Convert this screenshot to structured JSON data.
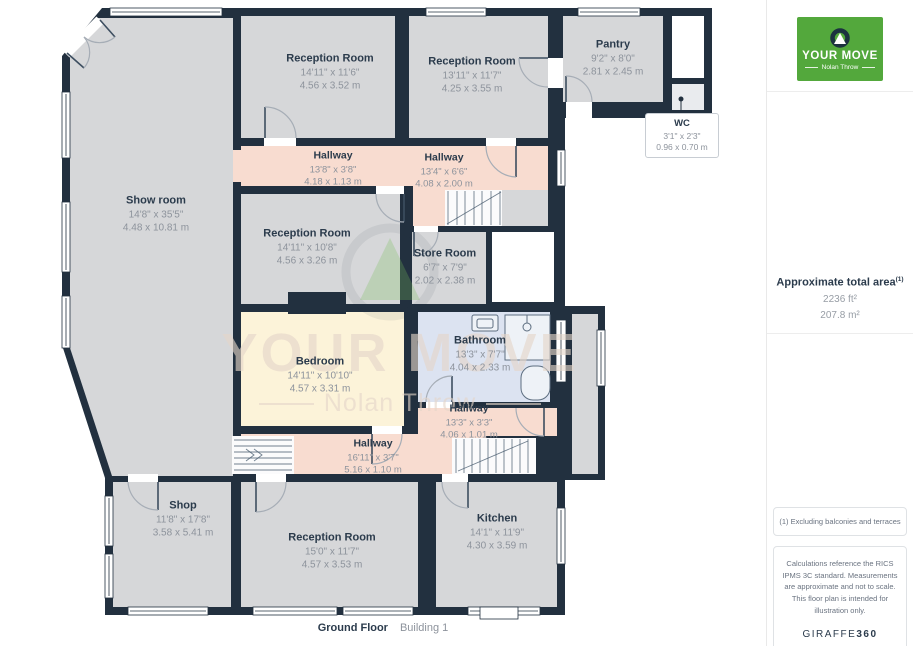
{
  "floorplan": {
    "footer": {
      "floor_label": "Ground Floor",
      "building_label": "Building 1"
    },
    "watermark": {
      "line1": "YOUR MOVE",
      "line2": "Nolan Throw"
    },
    "rooms": [
      {
        "name": "Reception Room",
        "imperial": "14'11\" x 11'6\"",
        "metric": "4.56 x 3.52 m"
      },
      {
        "name": "Reception Room",
        "imperial": "13'11\" x 11'7\"",
        "metric": "4.25 x 3.55 m"
      },
      {
        "name": "Pantry",
        "imperial": "9'2\" x 8'0\"",
        "metric": "2.81 x 2.45 m"
      },
      {
        "name": "WC",
        "imperial": "3'1\" x 2'3\"",
        "metric": "0.96 x 0.70 m"
      },
      {
        "name": "Show room",
        "imperial": "14'8\" x 35'5\"",
        "metric": "4.48 x 10.81 m"
      },
      {
        "name": "Hallway",
        "imperial": "13'8\" x 3'8\"",
        "metric": "4.18 x 1.13 m"
      },
      {
        "name": "Hallway",
        "imperial": "13'4\" x 6'6\"",
        "metric": "4.08 x 2.00 m"
      },
      {
        "name": "Reception Room",
        "imperial": "14'11\" x 10'8\"",
        "metric": "4.56 x 3.26 m"
      },
      {
        "name": "Store Room",
        "imperial": "6'7\" x 7'9\"",
        "metric": "2.02 x 2.38 m"
      },
      {
        "name": "Bedroom",
        "imperial": "14'11\" x 10'10\"",
        "metric": "4.57 x 3.31 m"
      },
      {
        "name": "Bathroom",
        "imperial": "13'3\" x 7'7\"",
        "metric": "4.04 x 2.33 m"
      },
      {
        "name": "Hallway",
        "imperial": "13'3\" x 3'3\"",
        "metric": "4.06 x 1.01 m"
      },
      {
        "name": "Hallway",
        "imperial": "16'11\" x 3'7\"",
        "metric": "5.16 x 1.10 m"
      },
      {
        "name": "Shop",
        "imperial": "11'8\" x 17'8\"",
        "metric": "3.58 x 5.41 m"
      },
      {
        "name": "Reception Room",
        "imperial": "15'0\" x 11'7\"",
        "metric": "4.57 x 3.53 m"
      },
      {
        "name": "Kitchen",
        "imperial": "14'1\" x 11'9\"",
        "metric": "4.30 x 3.59 m"
      }
    ]
  },
  "sidebar": {
    "logo": {
      "brand": "YOUR MOVE",
      "sub": "Nolan Throw"
    },
    "area": {
      "title": "Approximate total area",
      "superscript": "(1)",
      "imperial": "2236 ft²",
      "metric": "207.8 m²"
    },
    "footnote": "(1) Excluding balconies and terraces",
    "disclaimer": "Calculations reference the RICS IPMS 3C standard. Measurements are approximate and not to scale. This floor plan is intended for illustration only.",
    "brand_footer": {
      "name": "GIRAFFE",
      "suffix": "360"
    }
  },
  "colors": {
    "wall_navy": "#22303f",
    "room_gray": "#d6d7d9",
    "hallway_peach": "#f8dcd0",
    "bedroom_cream": "#fcf3d9",
    "bathroom_blue": "#dce3f1",
    "brand_green": "#53a83c"
  }
}
